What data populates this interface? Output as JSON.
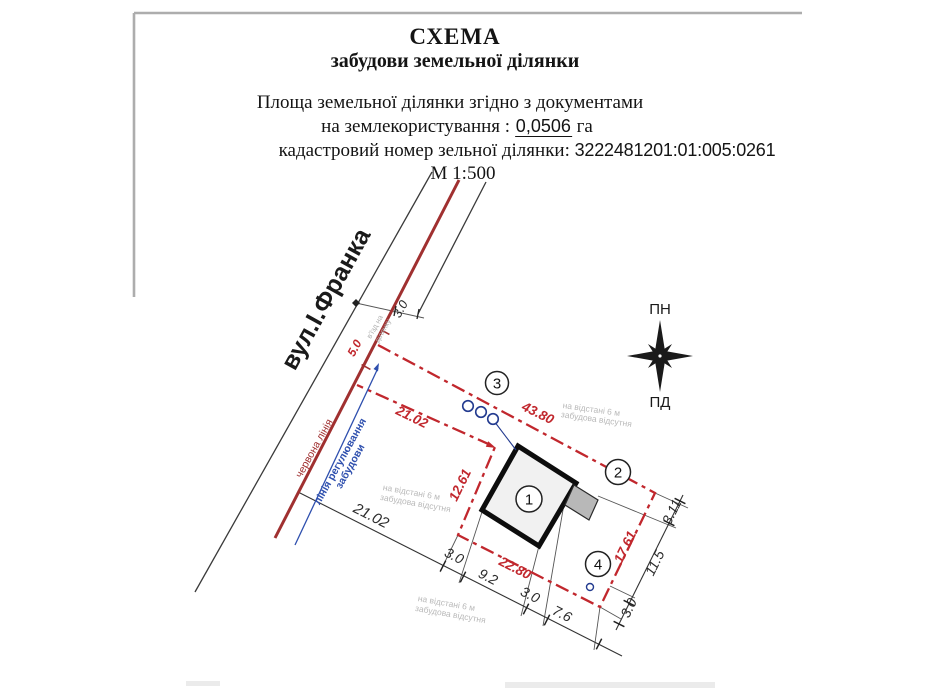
{
  "header": {
    "title_line1": "СХЕМА",
    "title_line2": "забудови земельної ділянки",
    "area_line": "Площа земельної  ділянки  згідно з документами",
    "landuse_prefix": "на землекористування :",
    "landuse_value": "0,0506",
    "landuse_suffix": "га",
    "cadastre_label": "кадастровий номер зельної ділянки:",
    "cadastre_value": "3222481201:01:005:0261",
    "scale": "М 1:500"
  },
  "diagram": {
    "street_name": "вул.І.Франка",
    "red_line_label": "червона лінія",
    "regulation_line_label1": "лінія регулювання",
    "regulation_line_label2": "забудови",
    "entrance_label1": "в'їзд на",
    "entrance_label2": "ділянку",
    "setback_note_line1": "на відстані 6 м",
    "setback_note_line2": "забудова відсутня",
    "compass": {
      "north": "ПН",
      "south": "ПД"
    },
    "markers": {
      "building": "1",
      "corner": "2",
      "wells": "3",
      "point": "4"
    },
    "dims": {
      "red": {
        "top": "43.80",
        "upper": "21.02",
        "left": "12.61",
        "bottom": "22.80",
        "right": "17.61",
        "entrance_width": "5.0"
      },
      "black": {
        "street_offset": "3.0",
        "chain_total": "21.02",
        "seg_a": "3.0",
        "seg_b": "9.2",
        "seg_c": "3.0",
        "seg_d": "7.6",
        "right_a": "3.0",
        "right_b": "11.5",
        "right_c": "3.11"
      }
    }
  },
  "colors": {
    "red_line": "#a03030",
    "boundary_red": "#c1272d",
    "regulation_blue": "#2e4fae",
    "dim_black": "#2b2b2b",
    "note_gray": "#b9b9b9",
    "frame_gray": "#adadad"
  }
}
